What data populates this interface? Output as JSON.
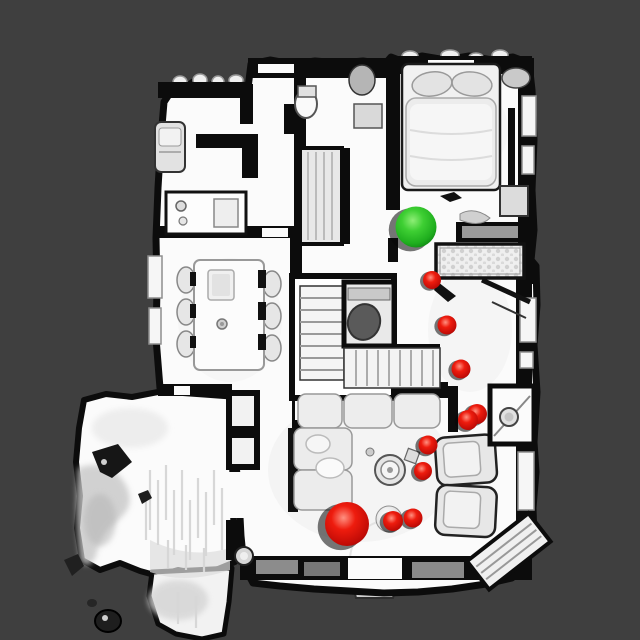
{
  "scene": {
    "description": "top-down-3d-mesh-floorplan",
    "background_color": "#3f3f3f",
    "floor_color": "#fbfbfb",
    "wall_color": "#0c0c0c",
    "markers": {
      "goal": {
        "label": "green-sphere",
        "color": "#2ec62a",
        "x": 416,
        "y": 227,
        "r": 20.5
      },
      "agent": {
        "label": "large-red-sphere",
        "color": "#e3120b",
        "x": 347,
        "y": 524,
        "r": 22
      },
      "waypoints": {
        "label": "red-sphere-trail",
        "color": "#e3120b",
        "points": [
          {
            "x": 432,
            "y": 280,
            "r": 9.0
          },
          {
            "x": 447,
            "y": 325,
            "r": 9.5
          },
          {
            "x": 461,
            "y": 369,
            "r": 9.5
          },
          {
            "x": 477,
            "y": 414,
            "r": 10.0
          },
          {
            "x": 468,
            "y": 420,
            "r": 10.0
          },
          {
            "x": 428,
            "y": 445,
            "r": 9.5
          },
          {
            "x": 423,
            "y": 471,
            "r": 9.0
          },
          {
            "x": 413,
            "y": 518,
            "r": 9.5
          },
          {
            "x": 393,
            "y": 521,
            "r": 10.0
          }
        ]
      }
    }
  }
}
